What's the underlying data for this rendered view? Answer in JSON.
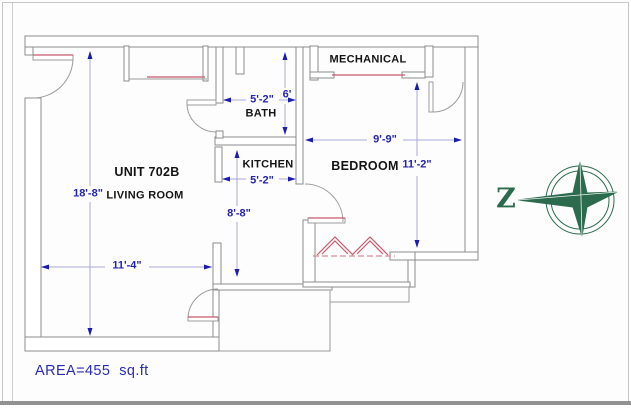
{
  "page": {
    "area_label": "AREA=455  sq.ft"
  },
  "plan": {
    "unit_title": "UNIT 702B",
    "rooms": [
      {
        "name": "LIVING ROOM"
      },
      {
        "name": "BATH"
      },
      {
        "name": "KITCHEN"
      },
      {
        "name": "BEDROOM"
      },
      {
        "name": "MECHANICAL"
      }
    ],
    "dimensions": [
      {
        "room": "living room",
        "value": "18'-8\"",
        "orientation": "vertical"
      },
      {
        "room": "living room",
        "value": "11'-4\"",
        "orientation": "horizontal"
      },
      {
        "room": "bath",
        "value": "5'-2\"",
        "orientation": "horizontal"
      },
      {
        "room": "bath",
        "value": "6'",
        "orientation": "vertical"
      },
      {
        "room": "kitchen",
        "value": "5'-2\"",
        "orientation": "horizontal"
      },
      {
        "room": "kitchen hall",
        "value": "8'-8\"",
        "orientation": "vertical"
      },
      {
        "room": "bedroom",
        "value": "9'-9\"",
        "orientation": "horizontal"
      },
      {
        "room": "bedroom",
        "value": "11'-2\"",
        "orientation": "vertical"
      }
    ]
  },
  "compass": {
    "letter": "Z"
  },
  "colors": {
    "wall": "#8c8c8c",
    "door_arc": "#9c9c9c",
    "dim_line": "#a9a9da",
    "dim_text": "#2323b4",
    "accent_red": "#c85a6e",
    "label_text": "#141414",
    "compass_green": "#2c6b4e"
  }
}
